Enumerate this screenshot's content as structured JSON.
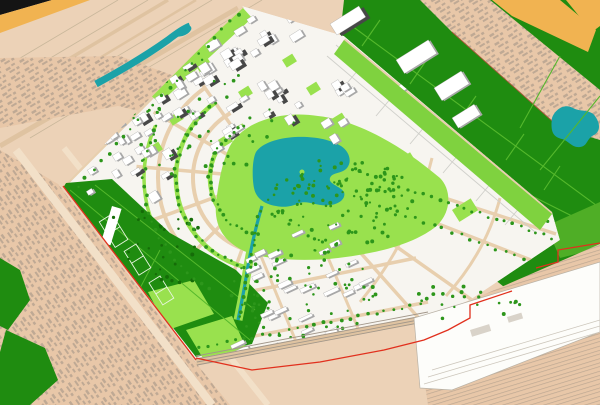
{
  "palette": {
    "base_tan": "#ecd2b7",
    "fabric_tan": "#e8c7a8",
    "fabric_mark": "#9d9082",
    "field_line": "#c9b79b",
    "road_tan": "#dfc3a1",
    "road_light": "#f2e0c8",
    "street_tan": "#e8cfae",
    "black": "#141414",
    "orange": "#f1b351",
    "water": "#1ba2a8",
    "green_dark": "#1f8c10",
    "green_mid": "#4fae26",
    "green_path": "#55b82c",
    "green_light_strip": "#7fd23f",
    "lawn": "#99e14e",
    "tree": "#2d961b",
    "tree_dark": "#156c08",
    "building_white": "#ffffff",
    "building_side": "#a8a8a8",
    "tower_dark": "#474747",
    "building_edge": "#9a9a9a",
    "parcel": "#f7f5f0",
    "parcel_line": "#cfcfca",
    "red_boundary": "#e1301d",
    "rail": "#a2978a",
    "yard_white": "#fdfdfa",
    "shed": "#d9d3c9",
    "pitch_line": "#e8f5e0",
    "fabric_edge_red": "#a85838"
  },
  "buildings": {
    "clusters": [
      {
        "name": "northwest-towers",
        "x": 92,
        "y": 52,
        "w": 215,
        "h": 125,
        "angle": -32,
        "count": 56,
        "min_w": 5,
        "max_w": 12,
        "min_h": 4,
        "max_h": 10,
        "tall_ratio": 0.34
      },
      {
        "name": "north-blocks",
        "x": 200,
        "y": 6,
        "w": 140,
        "h": 48,
        "angle": -32,
        "count": 16,
        "min_w": 6,
        "max_w": 14,
        "min_h": 5,
        "max_h": 9,
        "tall_ratio": 0.25
      },
      {
        "name": "west-edge-blocks",
        "x": 70,
        "y": 116,
        "w": 92,
        "h": 74,
        "angle": -32,
        "count": 15,
        "min_w": 5,
        "max_w": 10,
        "min_h": 4,
        "max_h": 8,
        "tall_ratio": 0.12
      },
      {
        "name": "lake-east-blocks",
        "x": 300,
        "y": 60,
        "w": 108,
        "h": 86,
        "angle": -32,
        "count": 11,
        "min_w": 6,
        "max_w": 12,
        "min_h": 5,
        "max_h": 9,
        "tall_ratio": 0.2
      },
      {
        "name": "garden-rows",
        "x": 243,
        "y": 232,
        "w": 125,
        "h": 84,
        "angle": -25,
        "count": 21,
        "min_w": 10,
        "max_w": 16,
        "min_h": 3,
        "max_h": 5,
        "tall_ratio": 0
      },
      {
        "name": "south-rows",
        "x": 212,
        "y": 312,
        "w": 128,
        "h": 60,
        "angle": -25,
        "count": 13,
        "min_w": 10,
        "max_w": 15,
        "min_h": 3,
        "max_h": 5,
        "tall_ratio": 0
      }
    ],
    "fixed": [
      {
        "x": 330,
        "y": 24,
        "w": 34,
        "h": 13,
        "angle": -32,
        "tall": true
      },
      {
        "x": 396,
        "y": 60,
        "w": 38,
        "h": 16,
        "angle": -32,
        "tall": false
      },
      {
        "x": 434,
        "y": 88,
        "w": 32,
        "h": 15,
        "angle": -32,
        "tall": false
      },
      {
        "x": 452,
        "y": 118,
        "w": 26,
        "h": 12,
        "angle": -32,
        "tall": false
      }
    ]
  },
  "trees": {
    "areas": [
      {
        "name": "lake-park",
        "cx": 342,
        "cy": 202,
        "rx": 74,
        "ry": 44,
        "count": 115,
        "color_key": "tree",
        "clip": true
      },
      {
        "name": "south-garden",
        "cx": 300,
        "cy": 294,
        "rx": 76,
        "ry": 48,
        "count": 70,
        "color_key": "tree",
        "clip": true
      },
      {
        "name": "crescent",
        "cx": 205,
        "cy": 120,
        "rx": 92,
        "ry": 62,
        "count": 48,
        "color_key": "tree",
        "clip": true
      },
      {
        "name": "west-park",
        "cx": 152,
        "cy": 258,
        "rx": 58,
        "ry": 58,
        "count": 38,
        "color_key": "tree_dark",
        "clip": true
      },
      {
        "name": "southeast-edge",
        "cx": 470,
        "cy": 300,
        "rx": 55,
        "ry": 22,
        "count": 22,
        "color_key": "tree",
        "clip": false
      }
    ],
    "lines": [
      {
        "name": "belt-inner",
        "pts": [
          [
            340,
            52
          ],
          [
            548,
            222
          ]
        ],
        "count": 30,
        "color_key": "tree",
        "clip": true
      },
      {
        "name": "fan-street-1",
        "pts": [
          [
            352,
            170
          ],
          [
            552,
            238
          ]
        ],
        "count": 26,
        "color_key": "tree",
        "clip": true
      },
      {
        "name": "fan-street-2",
        "pts": [
          [
            344,
            192
          ],
          [
            532,
            262
          ]
        ],
        "count": 22,
        "color_key": "tree",
        "clip": true
      },
      {
        "name": "south-boundary",
        "pts": [
          [
            200,
            348
          ],
          [
            420,
            304
          ]
        ],
        "count": 26,
        "color_key": "tree",
        "clip": true
      },
      {
        "name": "canal-banks",
        "pts": [
          [
            260,
            210
          ],
          [
            240,
            318
          ]
        ],
        "count": 16,
        "color_key": "tree",
        "clip": true
      },
      {
        "name": "northwest-edge",
        "pts": [
          [
            78,
            186
          ],
          [
            238,
            14
          ]
        ],
        "count": 22,
        "color_key": "tree",
        "clip": true
      }
    ],
    "arcs": [
      {
        "name": "crescent-avenue-inner",
        "cx": 268,
        "cy": 178,
        "r": 58,
        "a1": 100,
        "a2": 245,
        "count": 26
      },
      {
        "name": "crescent-avenue-outer",
        "cx": 268,
        "cy": 178,
        "r": 92,
        "a1": 105,
        "a2": 235,
        "count": 30
      },
      {
        "name": "crescent-avenue-third",
        "cx": 268,
        "cy": 178,
        "r": 124,
        "a1": 118,
        "a2": 205,
        "count": 22
      }
    ]
  },
  "lawn_rects": [
    {
      "x": 196,
      "y": 66,
      "w": 14,
      "h": 10,
      "angle": -32
    },
    {
      "x": 238,
      "y": 92,
      "w": 12,
      "h": 9,
      "angle": -32
    },
    {
      "x": 168,
      "y": 118,
      "w": 13,
      "h": 9,
      "angle": -32
    },
    {
      "x": 258,
      "y": 128,
      "w": 14,
      "h": 10,
      "angle": -32
    },
    {
      "x": 148,
      "y": 148,
      "w": 12,
      "h": 9,
      "angle": -32
    },
    {
      "x": 306,
      "y": 88,
      "w": 12,
      "h": 9,
      "angle": -32
    },
    {
      "x": 126,
      "y": 96,
      "w": 11,
      "h": 8,
      "angle": -32
    },
    {
      "x": 218,
      "y": 140,
      "w": 12,
      "h": 9,
      "angle": -32
    },
    {
      "x": 388,
      "y": 166,
      "w": 26,
      "h": 16,
      "angle": -32
    },
    {
      "x": 452,
      "y": 210,
      "w": 22,
      "h": 14,
      "angle": -32
    },
    {
      "x": 330,
      "y": 120,
      "w": 14,
      "h": 10,
      "angle": -32
    },
    {
      "x": 282,
      "y": 60,
      "w": 12,
      "h": 9,
      "angle": -32
    }
  ]
}
